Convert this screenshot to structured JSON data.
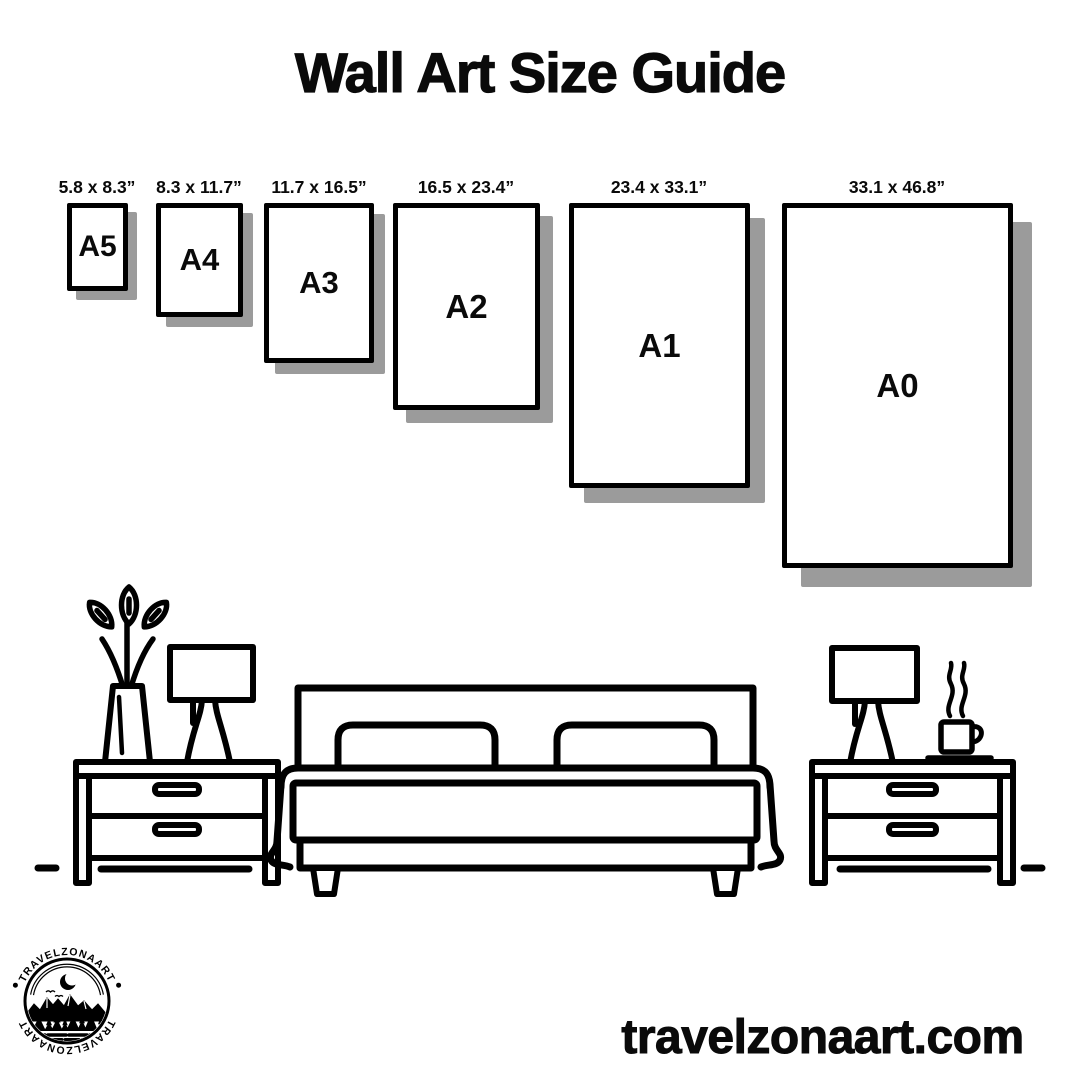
{
  "page": {
    "background": "#ffffff",
    "ink": "#000000",
    "shadow_color": "#9b9b9b"
  },
  "title": "Wall Art Size Guide",
  "sizes": [
    {
      "code": "A5",
      "dimensions": "5.8 x 8.3”"
    },
    {
      "code": "A4",
      "dimensions": "8.3 x 11.7”"
    },
    {
      "code": "A3",
      "dimensions": "11.7 x 16.5”"
    },
    {
      "code": "A2",
      "dimensions": "16.5 x 23.4”"
    },
    {
      "code": "A1",
      "dimensions": "23.4 x 33.1”"
    },
    {
      "code": "A0",
      "dimensions": "33.1 x 46.8”"
    }
  ],
  "scene": {
    "items": [
      "plant-vase",
      "table-lamp",
      "nightstand",
      "double-bed",
      "nightstand",
      "table-lamp",
      "steaming-coffee-cup"
    ]
  },
  "logo": {
    "brand_top": "TRAVELZONAART",
    "brand_bottom": "TRAVELZONAART"
  },
  "footer": {
    "website": "travelzonaart.com"
  }
}
